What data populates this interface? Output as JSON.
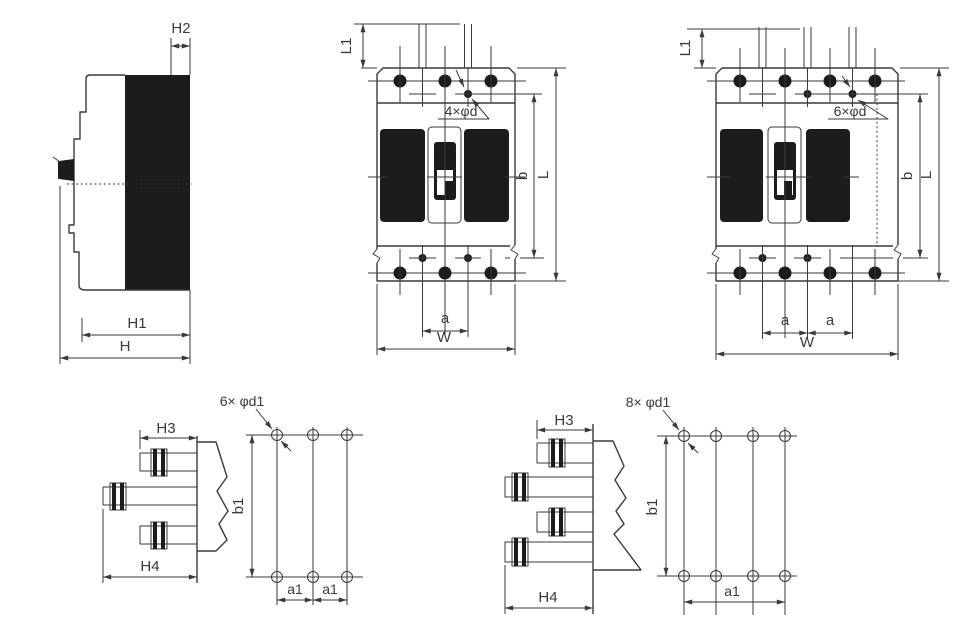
{
  "colors": {
    "line": "#3a3a3a",
    "ink": "#1c1c1c",
    "background": "#ffffff"
  },
  "views": {
    "side": {
      "h2": "H2",
      "h1": "H1",
      "h": "H"
    },
    "front3p": {
      "l1": "L1",
      "mount_holes": "4×φd",
      "b": "b",
      "l": "L",
      "a": "a",
      "w": "W"
    },
    "front4p": {
      "l1": "L1",
      "mount_holes": "6×φd",
      "b": "b",
      "l": "L",
      "a_left": "a",
      "a_right": "a",
      "w": "W"
    },
    "rear3p": {
      "holes": "6× φd1",
      "h3": "H3",
      "h4": "H4",
      "b1": "b1",
      "a1_left": "a1",
      "a1_right": "a1"
    },
    "rear4p": {
      "holes": "8× φd1",
      "h3": "H3",
      "h4": "H4",
      "b1": "b1",
      "a1": "a1"
    }
  }
}
